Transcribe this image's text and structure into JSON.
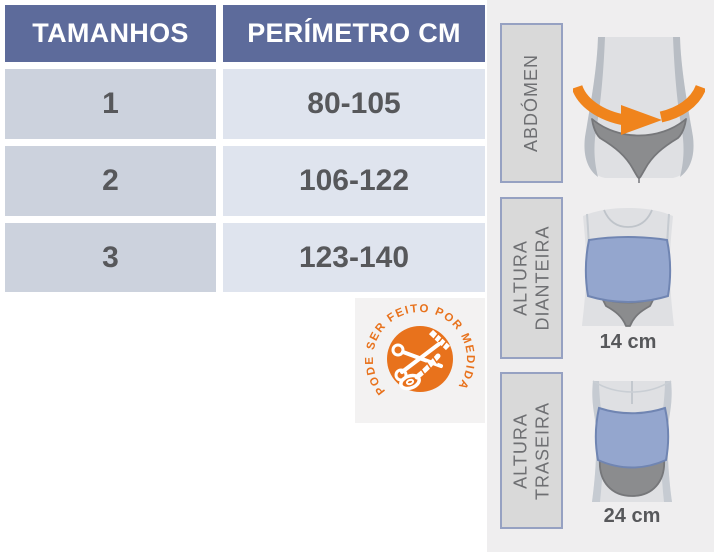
{
  "table": {
    "headers": {
      "sizes": "TAMANHOS",
      "perimeter": "PERÍMETRO CM"
    },
    "rows": [
      {
        "size": "1",
        "perimeter": "80-105"
      },
      {
        "size": "2",
        "perimeter": "106-122"
      },
      {
        "size": "3",
        "perimeter": "123-140"
      }
    ]
  },
  "badge": {
    "text": "PODE SER FEITO POR MEDIDA"
  },
  "panels": [
    {
      "label_line1": "ABDÓMEN"
    },
    {
      "label_line1": "ALTURA",
      "label_line2": "DIANTEIRA",
      "measurement": "14 cm"
    },
    {
      "label_line1": "ALTURA",
      "label_line2": "TRASEIRA",
      "measurement": "24 cm"
    }
  ],
  "colors": {
    "header_bg": "#5d6b9b",
    "cell_size_bg": "#ccd2dd",
    "cell_perimeter_bg": "#dfe4ee",
    "accent_orange": "#e8721c",
    "arrow_orange": "#f0841c",
    "belt_blue": "#94a6ce",
    "panel_bg": "#efeeef",
    "label_box_bg": "#d9d9d9",
    "label_box_border": "#96a1c2",
    "body_gray": "#dfe0e3",
    "underwear_gray": "#8b8c8e",
    "text_dark": "#57585b"
  }
}
